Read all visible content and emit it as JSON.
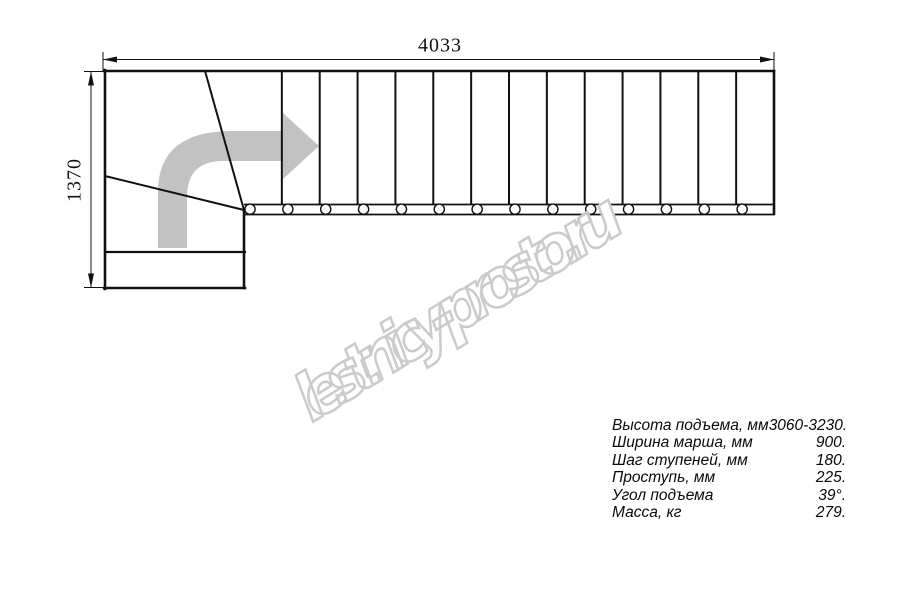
{
  "drawing_title": "stair-plan-top-view",
  "dimensions": {
    "width_label": "4033",
    "height_label": "1370"
  },
  "stair": {
    "flight_steps": 14,
    "bolt_count": 14,
    "direction_arrow": "turn-right-arrow-icon"
  },
  "specs": {
    "rows": [
      {
        "label": "Высота подъема, мм",
        "value": "3060-3230."
      },
      {
        "label": "Ширина марша, мм",
        "value": "900."
      },
      {
        "label": "Шаг ступеней, мм",
        "value": "180."
      },
      {
        "label": "Проступь, мм",
        "value": "225."
      },
      {
        "label": "Угол подъема",
        "value": "39°."
      },
      {
        "label": "Масса, кг",
        "value": "279."
      }
    ]
  },
  "watermark": {
    "text": "lestnicy-prosto.ru"
  },
  "colors": {
    "line": "#111111",
    "arrow_gray": "#c2c2c2",
    "watermark_gray": "#cbcbcb"
  }
}
